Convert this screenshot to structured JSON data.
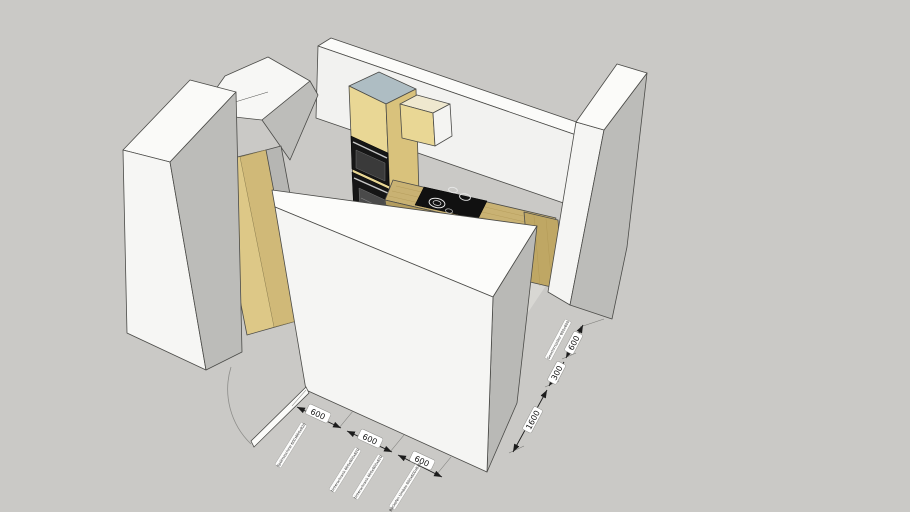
{
  "viewport": {
    "description": "3D kitchen model viewed from above in perspective",
    "background_color": "#cac9c6",
    "wall_color": "#f5f5f3",
    "wall_shade_color": "#b9b9b6",
    "cabinet_color": "#e9d795",
    "cabinet_top_color": "#aebdc3",
    "counter_color": "#c9b273",
    "appliance_color": "#161616"
  },
  "dimensions": {
    "bottom": [
      "600",
      "600",
      "600"
    ],
    "right": [
      "600",
      "300",
      "1600"
    ]
  },
  "labels": {
    "bottom": [
      "Spülmaschine 600x600x820",
      "Unterschrank 600x600x820",
      "Unterschrank 600x600x820",
      "Backofen Umbau 600x600x820"
    ],
    "right": [
      "Geschirrspüler 600x600"
    ]
  }
}
